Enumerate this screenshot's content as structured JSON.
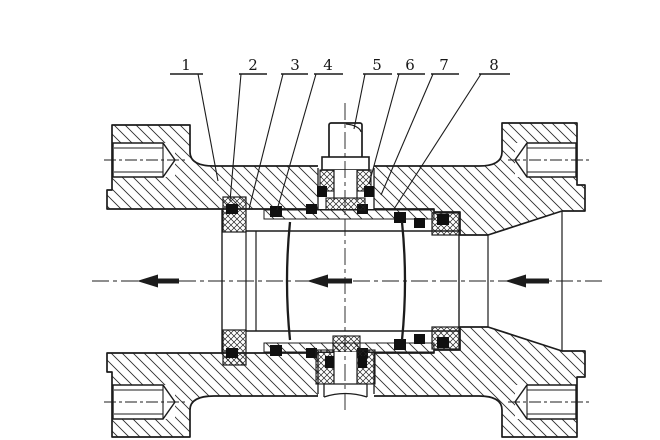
{
  "drawing": {
    "kind": "ball-valve-sectional-drawing",
    "colors": {
      "line": "#1c1c1c",
      "background": "#ffffff",
      "seal": "#101010",
      "hatch": "#2b2b2b"
    }
  },
  "callouts": [
    {
      "label": "1",
      "num_x": 186,
      "num_y": 70,
      "bar": [
        170,
        203
      ],
      "bar_y": 74,
      "leader_from": [
        198,
        74
      ],
      "leader_to": [
        218,
        181
      ]
    },
    {
      "label": "2",
      "num_x": 253,
      "num_y": 70,
      "bar": [
        239,
        267
      ],
      "bar_y": 74,
      "leader_from": [
        241,
        74
      ],
      "leader_to": [
        230,
        201
      ]
    },
    {
      "label": "3",
      "num_x": 295,
      "num_y": 70,
      "bar": [
        281,
        308
      ],
      "bar_y": 74,
      "leader_from": [
        283,
        74
      ],
      "leader_to": [
        249,
        209
      ]
    },
    {
      "label": "4",
      "num_x": 328,
      "num_y": 70,
      "bar": [
        314,
        343
      ],
      "bar_y": 74,
      "leader_from": [
        316,
        74
      ],
      "leader_to": [
        277,
        210
      ]
    },
    {
      "label": "5",
      "num_x": 377,
      "num_y": 70,
      "bar": [
        363,
        392
      ],
      "bar_y": 74,
      "leader_from": [
        365,
        74
      ],
      "leader_to": [
        354,
        129
      ]
    },
    {
      "label": "6",
      "num_x": 410,
      "num_y": 70,
      "bar": [
        397,
        425
      ],
      "bar_y": 74,
      "leader_from": [
        399,
        74
      ],
      "leader_to": [
        369,
        184
      ]
    },
    {
      "label": "7",
      "num_x": 444,
      "num_y": 70,
      "bar": [
        431,
        459
      ],
      "bar_y": 74,
      "leader_from": [
        433,
        74
      ],
      "leader_to": [
        381,
        195
      ]
    },
    {
      "label": "8",
      "num_x": 494,
      "num_y": 70,
      "bar": [
        479,
        510
      ],
      "bar_y": 74,
      "leader_from": [
        481,
        74
      ],
      "leader_to": [
        394,
        209
      ]
    }
  ],
  "flow_arrows": [
    {
      "tip_x": 137,
      "y": 281,
      "tail_x": 179
    },
    {
      "tip_x": 307,
      "y": 281,
      "tail_x": 352
    },
    {
      "tip_x": 505,
      "y": 281,
      "tail_x": 549
    }
  ]
}
